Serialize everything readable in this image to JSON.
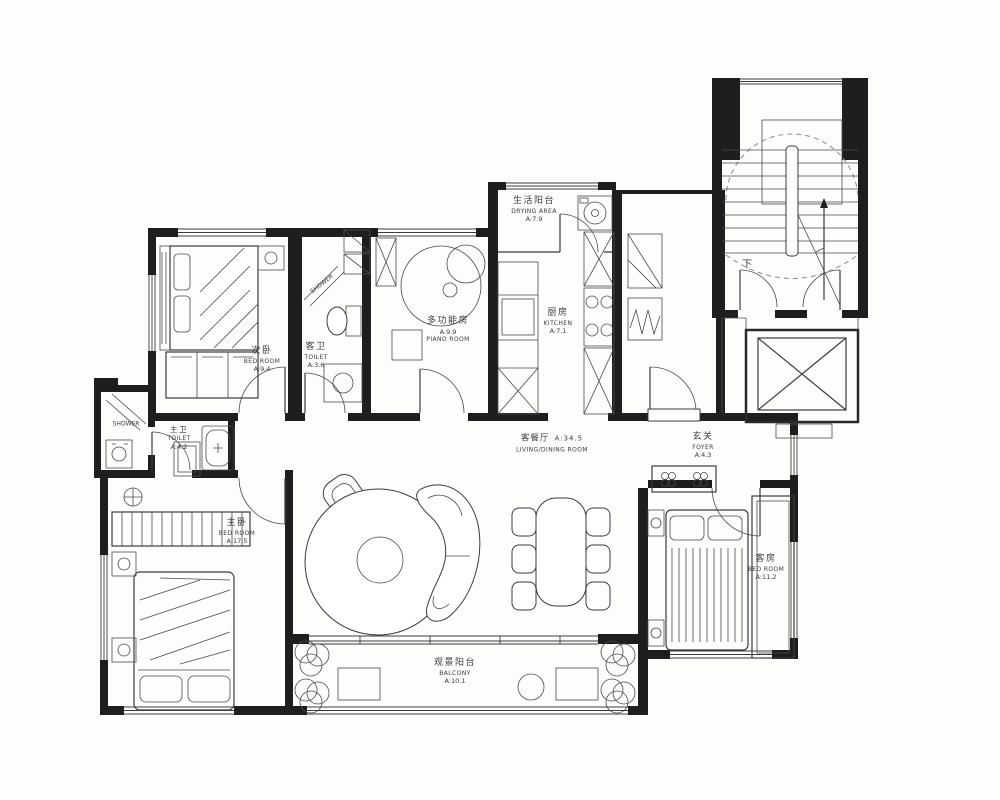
{
  "palette": {
    "wall": "#1e1e1e",
    "line": "#3c3c3c",
    "dash": "#8a8a8a",
    "text": "#3a3a3a"
  },
  "plan": {
    "rooms": {
      "second_bedroom": {
        "zh": "次卧",
        "en": "BED ROOM",
        "area": "A:9.4"
      },
      "guest_toilet": {
        "zh": "客卫",
        "en": "TOILET",
        "area": "A:3.6"
      },
      "piano_room": {
        "zh": "多功能房",
        "en": "PIANO ROOM",
        "area": "A:9.9"
      },
      "kitchen": {
        "zh": "厨房",
        "en": "KITCHEN",
        "area": "A:7.1"
      },
      "drying_area": {
        "zh": "生活阳台",
        "en": "DRYING AREA",
        "area": "A:7.9"
      },
      "living_dining": {
        "zh": "客餐厅",
        "en": "LIVING/DINING ROOM",
        "area": "A:34.5"
      },
      "foyer": {
        "zh": "玄关",
        "en": "FOYER",
        "area": "A:4.3"
      },
      "guest_bedroom": {
        "zh": "客房",
        "en": "BED ROOM",
        "area": "A:11.2"
      },
      "master_bedroom": {
        "zh": "主卧",
        "en": "BED ROOM",
        "area": "A:17.5"
      },
      "master_toilet": {
        "zh": "主卫",
        "en": "TOILET",
        "area": "A:4.2"
      },
      "balcony": {
        "zh": "观景阳台",
        "en": "BALCONY",
        "area": "A:10.1"
      }
    },
    "annotations": {
      "shower_master": "SHOWER",
      "shower_guest": "SHOWER",
      "stair_down": "下"
    }
  }
}
